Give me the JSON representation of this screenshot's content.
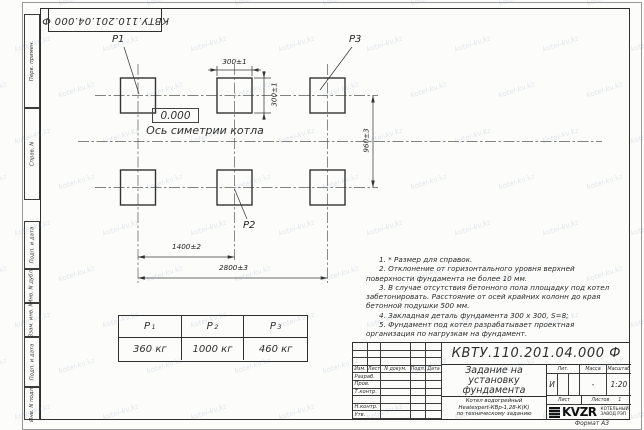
{
  "designation": "КВТУ.110.201.04.000 Ф",
  "watermark": {
    "text": "kotel-kv.kz"
  },
  "sheet": {
    "format_label": "Формат А3"
  },
  "margin": {
    "cells": [
      "Перв. примен.",
      "Справ. N",
      "Подп. и дата",
      "Инв. N дубл.",
      "Взам. инв. N",
      "Подп. и дата",
      "Инв. N подл."
    ]
  },
  "drawing": {
    "pad_labels": {
      "p1": "Р1",
      "p2": "Р2",
      "p3": "Р3"
    },
    "level_mark": "0.000",
    "axis_label": "Ось симетрии котла",
    "dimensions": {
      "pad_width": "300±1",
      "pad_height": "300±1",
      "row_spacing": "960±3",
      "col_spacing": "1400±2",
      "total_span": "2800±3"
    }
  },
  "load_table": {
    "headers": [
      {
        "base": "Р",
        "sub": "1"
      },
      {
        "base": "Р",
        "sub": "2"
      },
      {
        "base": "Р",
        "sub": "3"
      }
    ],
    "values": [
      "360 кг",
      "1000 кг",
      "460 кг"
    ]
  },
  "notes": [
    "1. * Размер для справок.",
    "2. Отклонение от горизонтального уровня верхней поверхности фундамента не более 10 мм.",
    "3. В случае отсутствия бетонного пола площадку под котел забетонировать. Расстояние от осей крайних колонн до края бетонной подушки 500 мм.",
    "4. Закладная деталь фундамента 300 х 300, S=8;",
    "5. Фундамент под котел разрабатывает проектная организация по нагрузкам на фундамент."
  ],
  "title_block": {
    "doc_title_lines": [
      "Задание на",
      "установку",
      "фундамента"
    ],
    "subtitle": [
      "Котел водогрейный",
      "Heatexpert-КВр-1,28-К(К)",
      "по техническому заданию"
    ],
    "columns": [
      "Изм.",
      "Лист",
      "N докум.",
      "Подп.",
      "Дата"
    ],
    "sig_rows": [
      "Разраб.",
      "Пров.",
      "Т.контр.",
      "",
      "Н.контр.",
      "Утв."
    ],
    "lit_label": "Лит.",
    "lit_value": "И",
    "mass_label": "Масса",
    "mass_value": "-",
    "scale_label": "Масштаб",
    "scale_value": "1:20",
    "sheet_label": "Лист",
    "sheets_label": "Листов",
    "sheets_value": "1",
    "logo_text": "KVZR",
    "company_lines": [
      "КОТЕЛЬНЫЙ",
      "ЗАВОД РЭП"
    ]
  }
}
